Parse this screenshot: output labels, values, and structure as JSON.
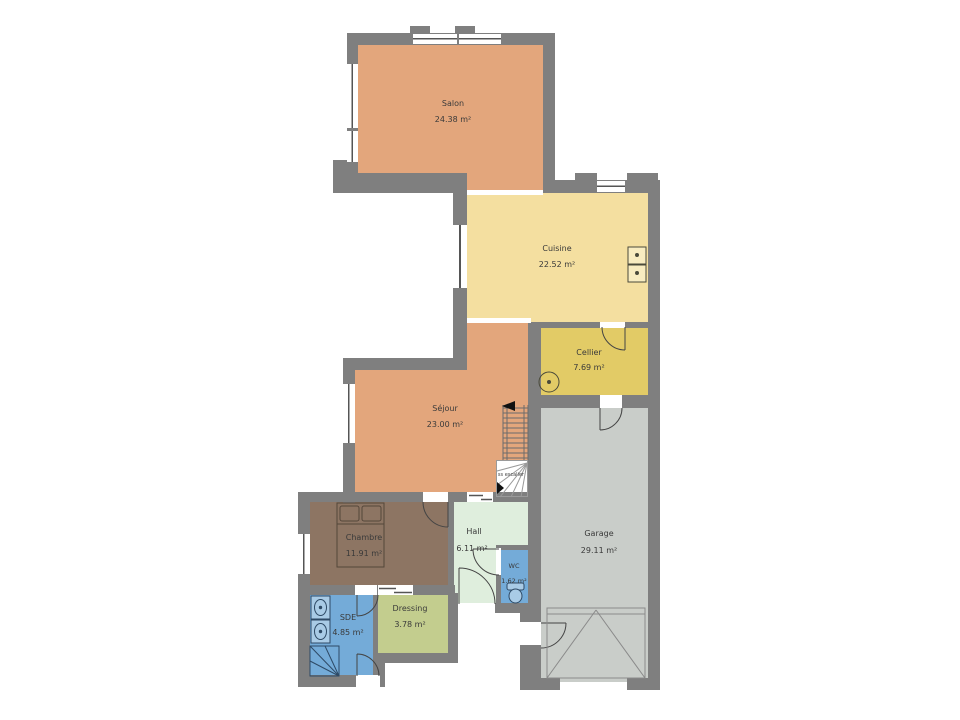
{
  "plan": {
    "rooms": {
      "salon": {
        "name": "Salon",
        "area": "24.38 m²"
      },
      "cuisine": {
        "name": "Cuisine",
        "area": "22.52 m²"
      },
      "cellier": {
        "name": "Cellier",
        "area": "7.69 m²"
      },
      "sejour": {
        "name": "Séjour",
        "area": "23.00 m²"
      },
      "chambre": {
        "name": "Chambre",
        "area": "11.91 m²"
      },
      "hall": {
        "name": "Hall",
        "area": "6.11 m²"
      },
      "wc": {
        "name": "WC",
        "area": "1.62 m²"
      },
      "garage": {
        "name": "Garage",
        "area": "29.11 m²"
      },
      "sde": {
        "name": "SDE",
        "area": "4.85 m²"
      },
      "dressing": {
        "name": "Dressing",
        "area": "3.78 m²"
      }
    },
    "stairs": {
      "label": "ss escalier"
    },
    "colors": {
      "wall": "#7f7f7f",
      "living": "#e3a67c",
      "kitchen": "#f4dfa0",
      "cellar": "#e2cb66",
      "bedroom": "#8d7563",
      "hall": "#dfeedd",
      "water": "#74abd8",
      "dressing": "#c3cd8e",
      "garage": "#c9cdc9"
    }
  }
}
